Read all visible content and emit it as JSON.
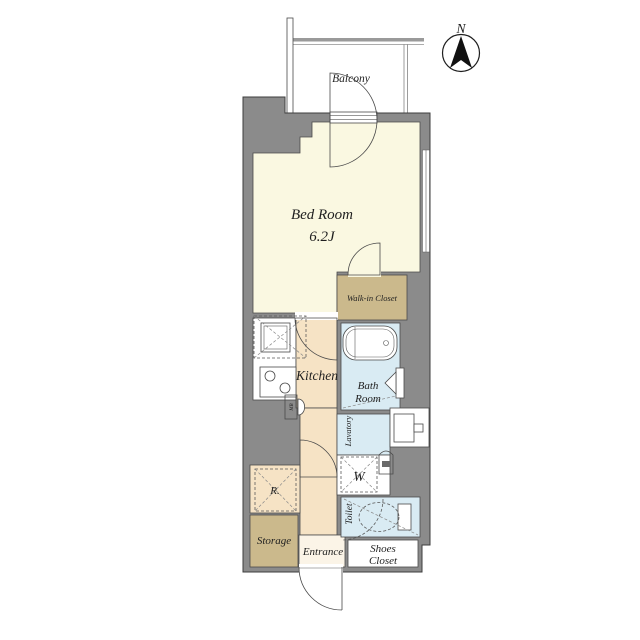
{
  "title": "Apartment floor plan",
  "compass": {
    "label": "N"
  },
  "rooms": {
    "balcony": {
      "label": "Balcony"
    },
    "bedroom": {
      "name": "Bed Room",
      "size": "6.2J"
    },
    "walk_in_closet": {
      "label": "Walk-in Closet"
    },
    "kitchen": {
      "label": "Kitchen"
    },
    "bath": {
      "line1": "Bath",
      "line2": "Room"
    },
    "lavatory": {
      "label": "Lavatory"
    },
    "washer": {
      "label": "W"
    },
    "toilet": {
      "label": "Toilet"
    },
    "refrigerator": {
      "label": "R."
    },
    "storage": {
      "label": "Storage"
    },
    "entrance": {
      "label": "Entrance"
    },
    "shoes_closet": {
      "line1": "Shoes",
      "line2": "Closet"
    },
    "meter_box": {
      "label": "MB"
    }
  },
  "colors": {
    "wall": "#8b8b8b",
    "outline": "#3c3c3c",
    "cream": "#faf8e1",
    "tan": "#cbb98c",
    "peach": "#f6e3c5",
    "blue": "#d9ebf3",
    "white": "#ffffff",
    "entrance_floor": "#fbf4e7",
    "railing": "#9a9a9a",
    "icon_dark": "#6a6a6a"
  }
}
